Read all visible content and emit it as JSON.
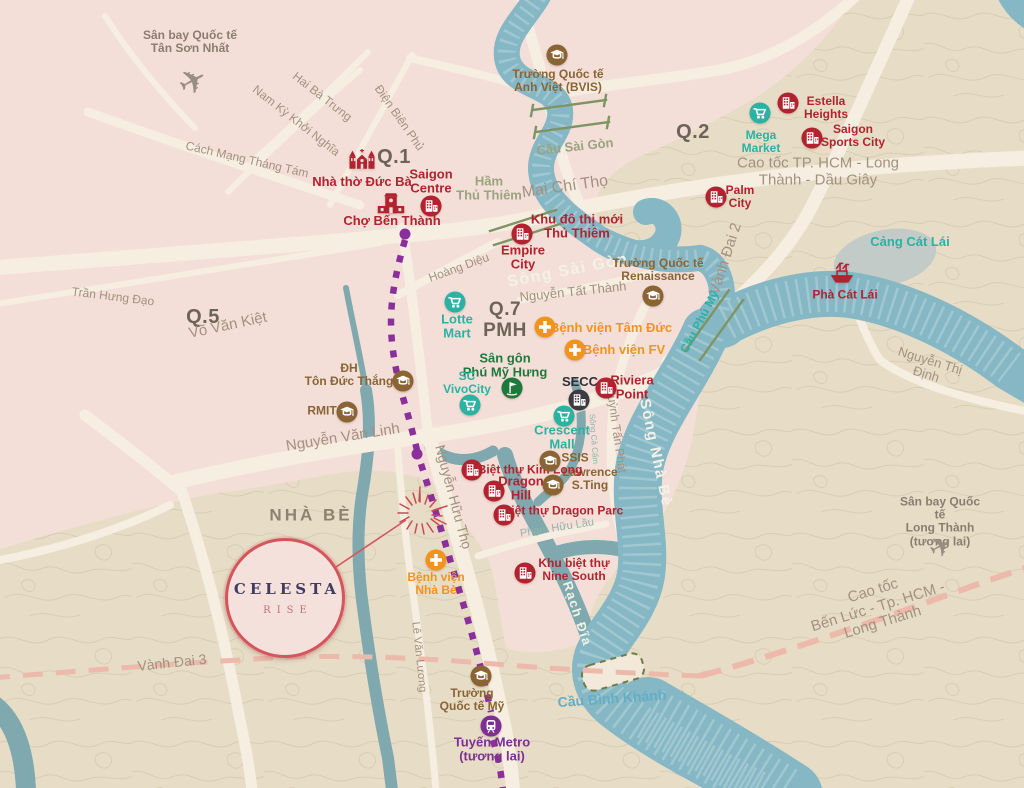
{
  "map": {
    "width": 1024,
    "height": 788,
    "region": "TP. Ho Chi Minh / Nha Be"
  },
  "project": {
    "title": "CELESTA",
    "subtitle": "RISE"
  },
  "palette": {
    "pink_zone": "#f3dfd8",
    "tan_zone": "#e7ddc7",
    "contour": "#d8ccb0",
    "road": "#f7eee2",
    "river": "#86b7c5",
    "river_wave": "#a6cbd3",
    "creek": "#7fa9ae",
    "red": "#b1232f",
    "teal": "#2bb2a2",
    "orange": "#f0941f",
    "brown": "#8a6434",
    "green": "#1e7a3c",
    "purple": "#7d2f92",
    "metro": "#8b2f9d",
    "street": "#a2917f",
    "district": "#6e6357",
    "nhabe": "#8d8172",
    "bridge": "#9aa37f",
    "bluebridge": "#63aec6",
    "canal": "#93b3a9",
    "poigray": "#8a7d6f",
    "dashed_road": "#ecb9ab",
    "badge_border": "#d6555d",
    "badge_title": "#413a61",
    "badge_sub": "#c0707b",
    "rails": "#7e9464"
  },
  "districts": [
    {
      "id": "district-q1",
      "lines": [
        "Q.1"
      ],
      "x": 394,
      "y": 157,
      "rot": 0,
      "size": 20,
      "cls": "district"
    },
    {
      "id": "district-q2",
      "lines": [
        "Q.2"
      ],
      "x": 693,
      "y": 132,
      "rot": 0,
      "size": 20,
      "cls": "district"
    },
    {
      "id": "district-q5",
      "lines": [
        "Q.5"
      ],
      "x": 203,
      "y": 317,
      "rot": 0,
      "size": 20,
      "cls": "district"
    },
    {
      "id": "district-q7-pmh",
      "lines": [
        "Q.7",
        "PMH"
      ],
      "x": 505,
      "y": 321,
      "rot": 0,
      "size": 19,
      "cls": "district"
    },
    {
      "id": "district-nha-be",
      "lines": [
        "NHÀ BÈ"
      ],
      "x": 311,
      "y": 516,
      "rot": 0,
      "size": 17,
      "cls": "nhabe"
    }
  ],
  "streets": [
    {
      "id": "street-hai-ba-trung",
      "lines": [
        "Hai Bà Trưng"
      ],
      "x": 322,
      "y": 97,
      "rot": 38,
      "size": 12,
      "cls": "street"
    },
    {
      "id": "street-nam-ky-khoi-nghia",
      "lines": [
        "Nam Kỳ Khởi Nghĩa"
      ],
      "x": 296,
      "y": 121,
      "rot": 38,
      "size": 12,
      "cls": "street"
    },
    {
      "id": "street-dien-bien-phu",
      "lines": [
        "Điện Biên Phủ"
      ],
      "x": 399,
      "y": 118,
      "rot": 55,
      "size": 12,
      "cls": "street"
    },
    {
      "id": "street-cach-mang-thang-tam",
      "lines": [
        "Cách Mạng Tháng Tám"
      ],
      "x": 247,
      "y": 160,
      "rot": 13,
      "size": 12,
      "cls": "street"
    },
    {
      "id": "street-tran-hung-dao",
      "lines": [
        "Trần Hưng Đạo"
      ],
      "x": 113,
      "y": 297,
      "rot": 7,
      "size": 12,
      "cls": "street"
    },
    {
      "id": "street-vo-van-kiet",
      "lines": [
        "Võ Văn Kiệt"
      ],
      "x": 228,
      "y": 326,
      "rot": -12,
      "size": 15,
      "cls": "street"
    },
    {
      "id": "street-mai-chi-tho",
      "lines": [
        "Mai Chí Thọ"
      ],
      "x": 565,
      "y": 187,
      "rot": -8,
      "size": 16,
      "cls": "street"
    },
    {
      "id": "street-hoang-dieu",
      "lines": [
        "Hoàng Diệu"
      ],
      "x": 459,
      "y": 268,
      "rot": -20,
      "size": 12,
      "cls": "street"
    },
    {
      "id": "street-nguyen-tat-thanh",
      "lines": [
        "Nguyễn Tất Thành"
      ],
      "x": 573,
      "y": 292,
      "rot": -6,
      "size": 13,
      "cls": "street"
    },
    {
      "id": "street-cao-toc-long-thanh-dau-giay",
      "lines": [
        "Cao tốc TP. HCM - Long Thành - Dầu Giây"
      ],
      "x": 818,
      "y": 172,
      "rot": 0,
      "size": 15,
      "cls": "street"
    },
    {
      "id": "street-vanh-dai-2",
      "lines": [
        "Vành Đai 2"
      ],
      "x": 726,
      "y": 259,
      "rot": -72,
      "size": 15,
      "cls": "street"
    },
    {
      "id": "street-nguyen-van-linh",
      "lines": [
        "Nguyễn Văn Linh"
      ],
      "x": 343,
      "y": 438,
      "rot": -9,
      "size": 15,
      "cls": "street"
    },
    {
      "id": "street-nguyen-huu-tho",
      "lines": [
        "Nguyễn Hữu Thọ"
      ],
      "x": 453,
      "y": 497,
      "rot": 75,
      "size": 14,
      "cls": "street"
    },
    {
      "id": "street-le-van-luong",
      "lines": [
        "Lê Văn Lương"
      ],
      "x": 419,
      "y": 657,
      "rot": 84,
      "size": 11,
      "cls": "street"
    },
    {
      "id": "street-huynh-tan-phat",
      "lines": [
        "Huỳnh Tấn Phát"
      ],
      "x": 616,
      "y": 430,
      "rot": 82,
      "size": 12,
      "cls": "street"
    },
    {
      "id": "street-nguyen-thi-dinh",
      "lines": [
        "Nguyễn Thị Định"
      ],
      "x": 928,
      "y": 368,
      "rot": 17,
      "size": 13,
      "cls": "street"
    },
    {
      "id": "street-vanh-dai-3",
      "lines": [
        "Vành Đai 3"
      ],
      "x": 172,
      "y": 663,
      "rot": -6,
      "size": 14,
      "cls": "street"
    },
    {
      "id": "street-cao-toc-ben-luc",
      "lines": [
        "Cao tốc",
        "Bến Lức - Tp. HCM - Long Thành"
      ],
      "x": 878,
      "y": 607,
      "rot": -17,
      "size": 15,
      "cls": "street"
    },
    {
      "id": "street-pham-huu-lau",
      "lines": [
        "Phạm Hữu Lầu"
      ],
      "x": 557,
      "y": 528,
      "rot": -9,
      "size": 11,
      "cls": "canal"
    }
  ],
  "waterways": [
    {
      "id": "label-song-sai-gon",
      "lines": [
        "Sông Sài Gòn"
      ],
      "x": 568,
      "y": 271,
      "rot": -11,
      "size": 16,
      "cls": "river"
    },
    {
      "id": "label-song-nha-be",
      "lines": [
        "Sông Nhà Bè"
      ],
      "x": 655,
      "y": 453,
      "rot": 78,
      "size": 15,
      "cls": "river"
    },
    {
      "id": "label-rach-dia",
      "lines": [
        "Rạch Đĩa"
      ],
      "x": 577,
      "y": 614,
      "rot": 72,
      "size": 13,
      "cls": "river"
    },
    {
      "id": "label-song-ca-cam",
      "lines": [
        "Sông Cả Cấm"
      ],
      "x": 593,
      "y": 439,
      "rot": 86,
      "size": 8,
      "cls": "canal"
    },
    {
      "id": "label-cau-sai-gon",
      "lines": [
        "Cầu Sài Gòn"
      ],
      "x": 575,
      "y": 147,
      "rot": -6,
      "size": 13,
      "cls": "bridge"
    },
    {
      "id": "label-ham-thu-thiem",
      "lines": [
        "Hầm",
        "Thủ Thiêm"
      ],
      "x": 489,
      "y": 189,
      "rot": 0,
      "size": 13,
      "cls": "bridge"
    },
    {
      "id": "label-cau-phu-my",
      "lines": [
        "Cầu Phú Mỹ"
      ],
      "x": 700,
      "y": 322,
      "rot": -62,
      "size": 12,
      "cls": "teal"
    },
    {
      "id": "label-cau-binh-khanh",
      "lines": [
        "Cầu Bình Khánh"
      ],
      "x": 612,
      "y": 699,
      "rot": -4,
      "size": 14,
      "cls": "bluebridge"
    },
    {
      "id": "label-cang-cat-lai",
      "lines": [
        "Cảng Cát Lái"
      ],
      "x": 910,
      "y": 242,
      "rot": 0,
      "size": 13,
      "cls": "teal"
    }
  ],
  "pois": [
    {
      "id": "label-airport-tan-son-nhat",
      "lines": [
        "Sân bay Quốc tế",
        "Tân Sơn Nhất"
      ],
      "x": 190,
      "y": 42,
      "rot": 0,
      "size": 12,
      "cls": "poi-gray"
    },
    {
      "id": "label-bvis-school",
      "lines": [
        "Trường Quốc tế",
        "Anh Việt (BVIS)"
      ],
      "x": 558,
      "y": 81,
      "rot": 0,
      "size": 12,
      "cls": "brown"
    },
    {
      "id": "label-mega-market",
      "lines": [
        "Mega",
        "Market"
      ],
      "x": 761,
      "y": 142,
      "rot": 0,
      "size": 12,
      "cls": "teal"
    },
    {
      "id": "label-estella-heights",
      "lines": [
        "Estella",
        "Heights"
      ],
      "x": 826,
      "y": 108,
      "rot": 0,
      "size": 12,
      "cls": "red"
    },
    {
      "id": "label-saigon-sports-city",
      "lines": [
        "Saigon",
        "Sports City"
      ],
      "x": 853,
      "y": 136,
      "rot": 0,
      "size": 12,
      "cls": "red"
    },
    {
      "id": "label-palm-city",
      "lines": [
        "Palm",
        "City"
      ],
      "x": 740,
      "y": 197,
      "rot": 0,
      "size": 12,
      "cls": "red"
    },
    {
      "id": "label-pha-cat-lai",
      "lines": [
        "Phà Cát Lái"
      ],
      "x": 845,
      "y": 295,
      "rot": 0,
      "size": 12,
      "cls": "red"
    },
    {
      "id": "label-nha-tho-duc-ba",
      "lines": [
        "Nhà thờ Đức Bà"
      ],
      "x": 362,
      "y": 182,
      "rot": 0,
      "size": 13,
      "cls": "red"
    },
    {
      "id": "label-saigon-centre",
      "lines": [
        "Saigon",
        "Centre"
      ],
      "x": 431,
      "y": 182,
      "rot": 0,
      "size": 13,
      "cls": "red"
    },
    {
      "id": "label-cho-ben-thanh",
      "lines": [
        "Chợ Bến Thành"
      ],
      "x": 392,
      "y": 221,
      "rot": 0,
      "size": 13,
      "cls": "red"
    },
    {
      "id": "label-khu-do-thi-thu-thiem",
      "lines": [
        "Khu đô thị mới",
        "Thủ Thiêm"
      ],
      "x": 577,
      "y": 227,
      "rot": 0,
      "size": 13,
      "cls": "red"
    },
    {
      "id": "label-empire-city",
      "lines": [
        "Empire",
        "City"
      ],
      "x": 523,
      "y": 258,
      "rot": 0,
      "size": 13,
      "cls": "red"
    },
    {
      "id": "label-renaissance-school",
      "lines": [
        "Trường Quốc tế",
        "Renaissance"
      ],
      "x": 658,
      "y": 270,
      "rot": 0,
      "size": 12,
      "cls": "brown"
    },
    {
      "id": "label-lotte-mart",
      "lines": [
        "Lotte",
        "Mart"
      ],
      "x": 457,
      "y": 327,
      "rot": 0,
      "size": 13,
      "cls": "teal"
    },
    {
      "id": "label-benh-vien-tam-duc",
      "lines": [
        "Bệnh viện Tâm Đức"
      ],
      "x": 611,
      "y": 328,
      "rot": 0,
      "size": 13,
      "cls": "orange"
    },
    {
      "id": "label-benh-vien-fv",
      "lines": [
        "Bệnh viện FV"
      ],
      "x": 624,
      "y": 350,
      "rot": 0,
      "size": 13,
      "cls": "orange"
    },
    {
      "id": "label-san-gon-phu-my-hung",
      "lines": [
        "Sân gôn",
        "Phú Mỹ Hưng"
      ],
      "x": 505,
      "y": 366,
      "rot": 0,
      "size": 13,
      "cls": "green"
    },
    {
      "id": "label-sc-vivocity",
      "lines": [
        "SC",
        "VivoCity"
      ],
      "x": 467,
      "y": 383,
      "rot": 0,
      "size": 12,
      "cls": "teal"
    },
    {
      "id": "label-secc",
      "lines": [
        "SECC"
      ],
      "x": 580,
      "y": 382,
      "rot": 0,
      "size": 13,
      "cls": "dark"
    },
    {
      "id": "label-riviera-point",
      "lines": [
        "Riviera",
        "Point"
      ],
      "x": 632,
      "y": 388,
      "rot": 0,
      "size": 13,
      "cls": "red"
    },
    {
      "id": "label-crescent-mall",
      "lines": [
        "Crescent",
        "Mall"
      ],
      "x": 562,
      "y": 438,
      "rot": 0,
      "size": 13,
      "cls": "teal"
    },
    {
      "id": "label-ssis",
      "lines": [
        "SSIS"
      ],
      "x": 575,
      "y": 458,
      "rot": 0,
      "size": 12,
      "cls": "brown"
    },
    {
      "id": "label-lawrence-sting",
      "lines": [
        "Lawrence",
        "S.Ting"
      ],
      "x": 590,
      "y": 479,
      "rot": 0,
      "size": 12,
      "cls": "brown"
    },
    {
      "id": "label-biet-thu-kim-long",
      "lines": [
        "Biệt thự Kim Long"
      ],
      "x": 530,
      "y": 470,
      "rot": 0,
      "size": 12,
      "cls": "red"
    },
    {
      "id": "label-dragon-hill",
      "lines": [
        "Dragon",
        "Hill"
      ],
      "x": 521,
      "y": 489,
      "rot": 0,
      "size": 13,
      "cls": "red"
    },
    {
      "id": "label-biet-thu-dragon-parc",
      "lines": [
        "Biệt thự Dragon Parc"
      ],
      "x": 563,
      "y": 511,
      "rot": 0,
      "size": 12,
      "cls": "red"
    },
    {
      "id": "label-nine-south",
      "lines": [
        "Khu biệt thự",
        "Nine South"
      ],
      "x": 574,
      "y": 570,
      "rot": 0,
      "size": 12,
      "cls": "red"
    },
    {
      "id": "label-benh-vien-nha-be",
      "lines": [
        "Bệnh viện",
        "Nhà Bè"
      ],
      "x": 436,
      "y": 584,
      "rot": 0,
      "size": 12,
      "cls": "orange"
    },
    {
      "id": "label-truong-quoc-te-my",
      "lines": [
        "Trường",
        "Quốc tế Mỹ"
      ],
      "x": 472,
      "y": 700,
      "rot": 0,
      "size": 12,
      "cls": "brown"
    },
    {
      "id": "label-tuyen-metro",
      "lines": [
        "Tuyến Metro",
        "(tương lai)"
      ],
      "x": 492,
      "y": 750,
      "rot": 0,
      "size": 13,
      "cls": "purple"
    },
    {
      "id": "label-airport-long-thanh",
      "lines": [
        "Sân bay Quốc tế",
        "Long Thành (tương lai)"
      ],
      "x": 940,
      "y": 522,
      "rot": 0,
      "size": 12,
      "cls": "poi-gray"
    }
  ],
  "markers": [
    {
      "id": "airport-tan-son-nhat-icon",
      "icon": "plane",
      "x": 193,
      "y": 82,
      "size": 34
    },
    {
      "id": "airport-long-thanh-icon",
      "icon": "plane",
      "x": 941,
      "y": 547,
      "size": 28
    },
    {
      "id": "bvis-school-icon",
      "icon": "school",
      "x": 557,
      "y": 55
    },
    {
      "id": "mega-market-icon",
      "icon": "cart",
      "x": 760,
      "y": 113
    },
    {
      "id": "estella-heights-icon",
      "icon": "building",
      "x": 788,
      "y": 103
    },
    {
      "id": "saigon-sports-city-icon",
      "icon": "building",
      "x": 812,
      "y": 138
    },
    {
      "id": "palm-city-icon",
      "icon": "building",
      "x": 716,
      "y": 197
    },
    {
      "id": "cat-lai-ferry-icon",
      "icon": "ship",
      "x": 842,
      "y": 271
    },
    {
      "id": "notre-dame-cathedral-icon",
      "icon": "cathedral",
      "x": 362,
      "y": 160
    },
    {
      "id": "ben-thanh-market-icon",
      "icon": "market",
      "x": 391,
      "y": 203
    },
    {
      "id": "saigon-centre-icon",
      "icon": "building",
      "x": 431,
      "y": 206
    },
    {
      "id": "empire-city-icon",
      "icon": "building",
      "x": 522,
      "y": 234
    },
    {
      "id": "renaissance-school-icon",
      "icon": "school",
      "x": 653,
      "y": 296
    },
    {
      "id": "lotte-mart-icon",
      "icon": "cart",
      "x": 455,
      "y": 302
    },
    {
      "id": "tam-duc-hospital-icon",
      "icon": "hospital",
      "x": 545,
      "y": 327
    },
    {
      "id": "fv-hospital-icon",
      "icon": "hospital",
      "x": 575,
      "y": 350
    },
    {
      "id": "pmh-golf-icon",
      "icon": "golf",
      "x": 512,
      "y": 388
    },
    {
      "id": "sc-vivocity-icon",
      "icon": "cart",
      "x": 470,
      "y": 405
    },
    {
      "id": "secc-icon",
      "icon": "expo",
      "x": 579,
      "y": 400
    },
    {
      "id": "riviera-point-icon",
      "icon": "building",
      "x": 606,
      "y": 388
    },
    {
      "id": "crescent-mall-icon",
      "icon": "cart",
      "x": 564,
      "y": 416
    },
    {
      "id": "ssis-school-icon",
      "icon": "school",
      "x": 550,
      "y": 461
    },
    {
      "id": "lawrence-sting-school-icon",
      "icon": "school",
      "x": 553,
      "y": 485
    },
    {
      "id": "kim-long-villas-icon",
      "icon": "building",
      "x": 472,
      "y": 470
    },
    {
      "id": "dragon-hill-icon",
      "icon": "building",
      "x": 494,
      "y": 491
    },
    {
      "id": "dragon-parc-icon",
      "icon": "building",
      "x": 504,
      "y": 515
    },
    {
      "id": "ton-duc-thang-icon",
      "icon": "school",
      "x": 403,
      "y": 381
    },
    {
      "id": "rmit-icon",
      "icon": "school",
      "x": 347,
      "y": 412
    },
    {
      "id": "nine-south-icon",
      "icon": "building",
      "x": 525,
      "y": 573
    },
    {
      "id": "nha-be-hospital-icon",
      "icon": "hospital",
      "x": 436,
      "y": 560
    },
    {
      "id": "american-school-icon",
      "icon": "school",
      "x": 481,
      "y": 676
    },
    {
      "id": "metro-line-icon",
      "icon": "metro",
      "x": 491,
      "y": 726
    }
  ],
  "extra_poi_labels": [
    {
      "id": "label-dh-ton-duc-thang",
      "lines": [
        "ĐH",
        "Tôn Đức Thắng"
      ],
      "x": 349,
      "y": 375,
      "rot": 0,
      "size": 12,
      "cls": "brown"
    },
    {
      "id": "label-rmit",
      "lines": [
        "RMIT"
      ],
      "x": 322,
      "y": 411,
      "rot": 0,
      "size": 12,
      "cls": "brown"
    }
  ]
}
